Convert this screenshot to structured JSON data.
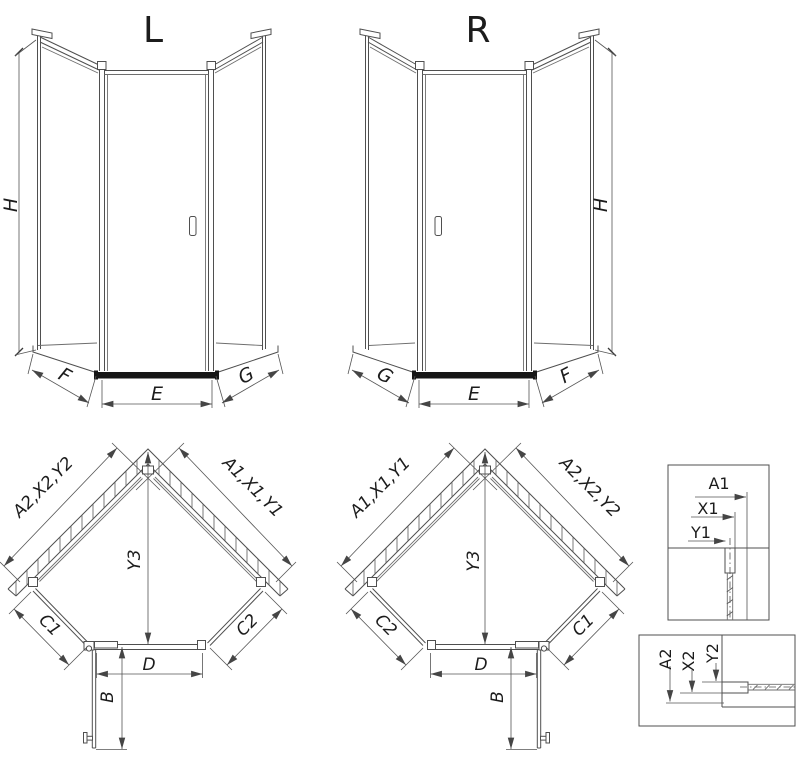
{
  "colors": {
    "line": "#4f4f4f",
    "dimension_line": "#555555",
    "text": "#1c1c1c",
    "dark_bar": "#161616",
    "background": "#ffffff"
  },
  "elevation_left": {
    "title": "L",
    "height_label": "H",
    "left_panel_label": "F",
    "door_label": "E",
    "right_panel_label": "G"
  },
  "elevation_right": {
    "title": "R",
    "height_label": "H",
    "left_panel_label": "G",
    "door_label": "E",
    "right_panel_label": "F"
  },
  "plan_left": {
    "left_wall_label": "A2,X2,Y2",
    "right_wall_label": "A1,X1,Y1",
    "depth_label": "Y3",
    "left_side_label": "C1",
    "right_side_label": "C2",
    "door_width_label": "D",
    "door_open_label": "B"
  },
  "plan_right": {
    "left_wall_label": "A1,X1,Y1",
    "right_wall_label": "A2,X2,Y2",
    "depth_label": "Y3",
    "left_side_label": "C2",
    "right_side_label": "C1",
    "door_width_label": "D",
    "door_open_label": "B"
  },
  "detail_top": {
    "dim_a": "A1",
    "dim_x": "X1",
    "dim_y": "Y1"
  },
  "detail_bottom": {
    "dim_a": "A2",
    "dim_x": "X2",
    "dim_y": "Y2"
  }
}
